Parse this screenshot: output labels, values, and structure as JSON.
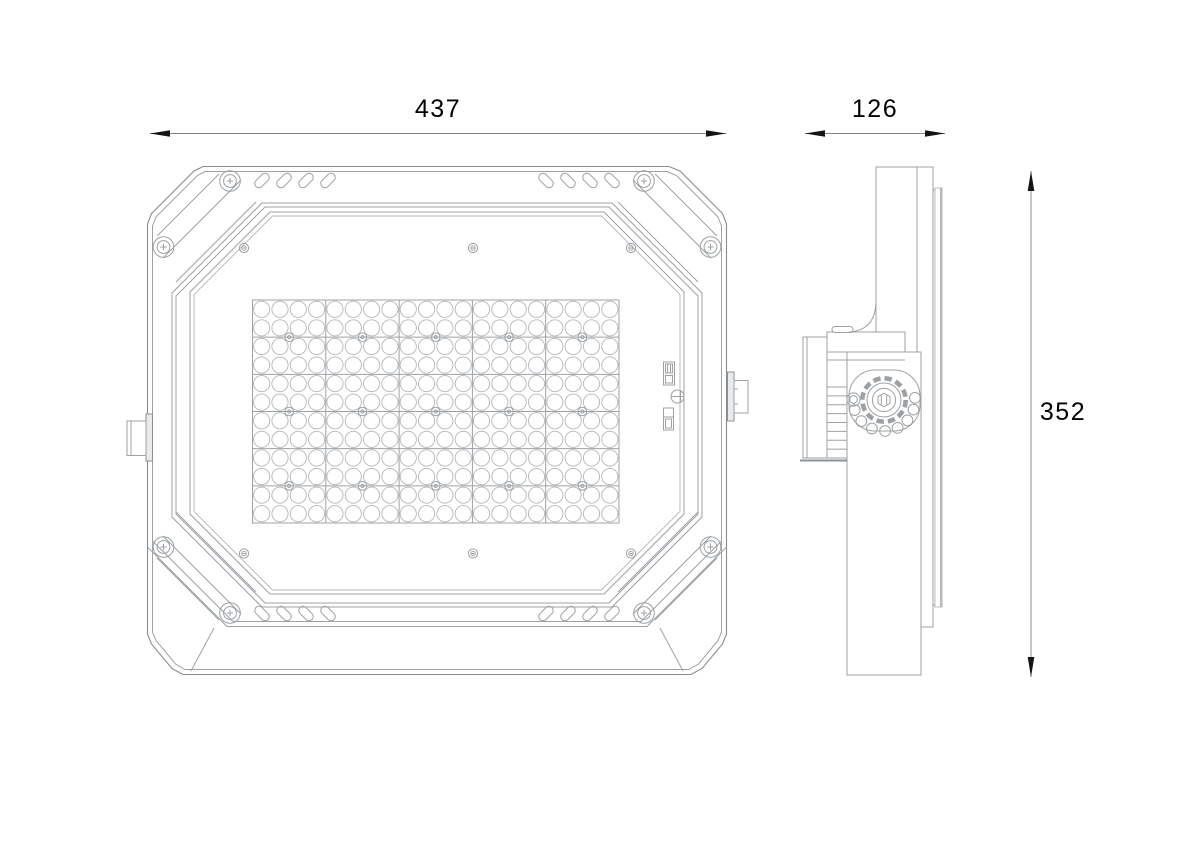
{
  "drawing": {
    "type": "technical-drawing",
    "subject": "led-floodlight-two-view-dimension-drawing",
    "views": {
      "left": "front-view",
      "right": "side-view"
    },
    "dimensions": {
      "front_width": "437",
      "side_depth": "126",
      "side_height": "352"
    },
    "front_view": {
      "led_panel": {
        "module_cols": 5,
        "module_rows": 6,
        "lens_cols": 20,
        "lens_rows": 12,
        "module_screws": 15
      },
      "bezel": {
        "corner_screws": 8,
        "top_slots": 8,
        "bottom_slots": 8,
        "glass_screws": 6
      },
      "slot_x": [
        262,
        284,
        306,
        328
      ],
      "corner_screw_pts": [
        [
          230,
          181
        ],
        [
          163.5,
          247
        ]
      ],
      "glass_screw_pts": [
        [
          244,
          248
        ],
        [
          473,
          248
        ],
        [
          631,
          248
        ],
        [
          244,
          553.5
        ],
        [
          473,
          553.5
        ],
        [
          631,
          553.5
        ]
      ]
    },
    "side_view": {
      "knob_lock_holes": 8,
      "knob_hole_angles_deg": [
        161,
        137,
        113,
        88,
        64,
        41,
        18,
        -4
      ],
      "serration_lines": 8
    },
    "colors": {
      "background": "#ffffff",
      "line": "#9da1a4",
      "line_dark": "#888c8f",
      "line_light": "#b3b6b8",
      "glass_edge": "#b6b9bb",
      "dim_line": "#7f8486",
      "arrow": "#141414",
      "text": "#000000"
    }
  }
}
